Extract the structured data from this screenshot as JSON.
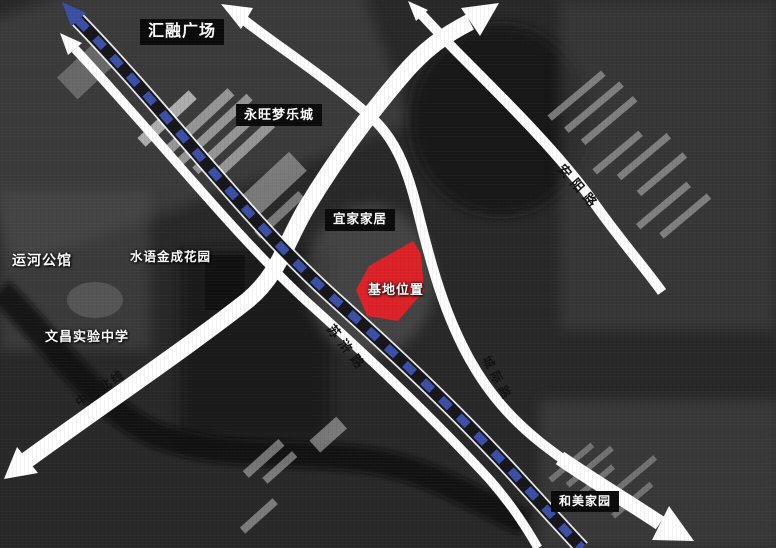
{
  "labels": {
    "huirong_plaza": "汇融广场",
    "aeon_dream_mall": "永旺梦乐城",
    "ikea_home": "宜家家居",
    "site_location": "基地位置",
    "yunhe_mansion": "运河公馆",
    "shuiyu_jincheng_garden": "水语金成花园",
    "wenchang_experimental_school": "文昌实验中学",
    "hemei_homeland": "和美家园"
  },
  "roads": {
    "suhu_road": "苏浒路",
    "chengji_road": "城际路",
    "anyang_road": "安阳路",
    "zhonghuan_north_line": "中环北线"
  },
  "colors": {
    "site_red": "#de2127",
    "railway_blue": "#3a4fa8",
    "road_white": "#ffffff",
    "label_bg": "#0a0a0a"
  }
}
